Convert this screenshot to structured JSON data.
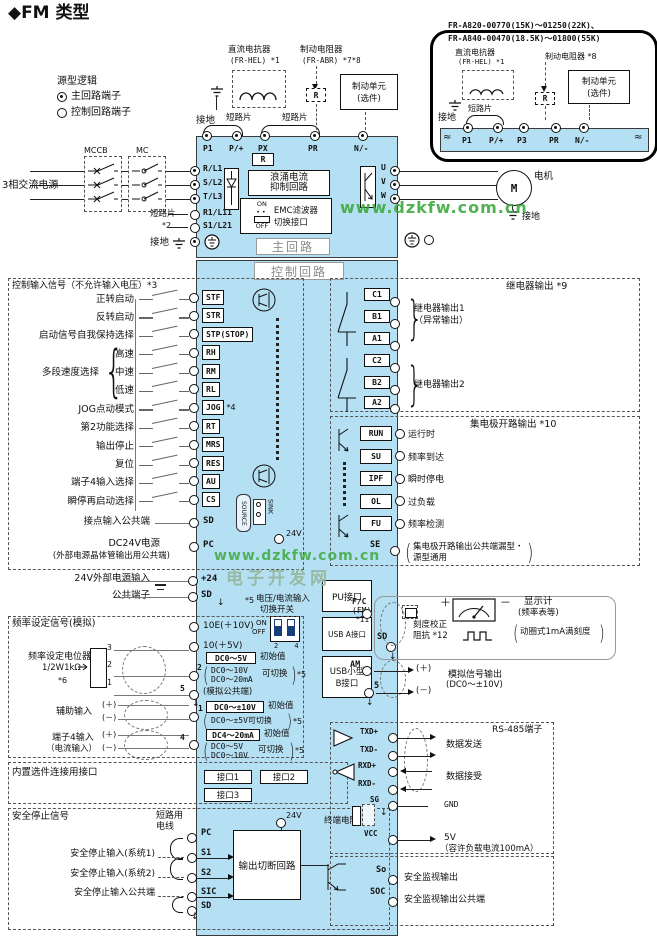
{
  "title": "◆FM 类型",
  "glyphs": {
    "paren_l": "(",
    "paren_r": ")",
    "brace_l": "{",
    "brace_r": "}",
    "arrow_down": "↓",
    "squiggle": "≈"
  },
  "legend": {
    "heading": "源型逻辑",
    "main": "主回路端子",
    "control": "控制回路端子"
  },
  "watermarks": {
    "url1": "www.dzkfw.com.cn",
    "url2": "www.dzkfw.com.cn",
    "site": "电子开发网"
  },
  "inset": {
    "model1": "FR-A820-00770(15K)～01250(22K)、",
    "model2": "FR-A840-00470(18.5K)～01800(55K)",
    "reactor_name": "直流电抗器",
    "reactor_model": "(FR-HEL) *1",
    "ground": "接地",
    "jumper": "短路片",
    "brake_resistor": "制动电阻器 *8",
    "r": "R",
    "brake_unit": "制动单元",
    "brake_unit_opt": "(选件)",
    "terminals": {
      "t1": "P1",
      "t2": "P/+",
      "t3": "P3",
      "t4": "PR",
      "t5": "N/-"
    }
  },
  "top": {
    "reactor_name": "直流电抗器",
    "reactor_model": "(FR-HEL) *1",
    "brake_resistor": "制动电阻器",
    "brake_resistor_model": "(FR-ABR) *7*8",
    "brake_unit": "制动单元",
    "brake_unit_opt": "(选件)",
    "ground": "接地",
    "jumper_left": "短路片",
    "jumper_right": "短路片",
    "r": "R",
    "terminals": {
      "t1": "P1",
      "t2": "P/+",
      "t3": "PX",
      "t4": "PR",
      "t5": "N/-"
    }
  },
  "main": {
    "mccb": "MCCB",
    "mc": "MC",
    "power": "3相交流电源",
    "r_l1": "R/L1",
    "s_l2": "S/L2",
    "t_l3": "T/L3",
    "r1_l11": "R1/L11",
    "s1_l21": "S1/L21",
    "jumper": "短路片",
    "jumper_note": "*2",
    "ground_in": "接地",
    "r": "R",
    "surge1": "浪涌电流",
    "surge2": "抑制回路",
    "emc_on": "ON",
    "emc_off": "OFF",
    "emc1": "EMC滤波器",
    "emc2": "切换接口",
    "main_circuit": "主回路",
    "control_circuit": "控制回路",
    "u": "U",
    "v": "V",
    "w": "W",
    "motor": "M",
    "motor_label": "电机",
    "ground_out": "接地"
  },
  "inputs": {
    "heading": "控制输入信号（不允许输入电压）*3",
    "rows": [
      {
        "label": "正转启动",
        "term": "STF"
      },
      {
        "label": "反转启动",
        "term": "STR"
      },
      {
        "label": "启动信号自我保持选择",
        "term": "STP(STOP)"
      },
      {
        "label": "高速",
        "term": "RH"
      },
      {
        "label": "中速",
        "term": "RM"
      },
      {
        "label": "低速",
        "term": "RL"
      },
      {
        "label": "JOG点动模式",
        "term": "JOG",
        "note": "*4"
      },
      {
        "label": "第2功能选择",
        "term": "RT"
      },
      {
        "label": "输出停止",
        "term": "MRS"
      },
      {
        "label": "复位",
        "term": "RES"
      },
      {
        "label": "端子4输入选择",
        "term": "AU"
      },
      {
        "label": "瞬停再启动选择",
        "term": "CS"
      }
    ],
    "group_label": "多段速度选择",
    "common_label": "接点输入公共端",
    "common_term": "SD",
    "pc_label1": "DC24V电源",
    "pc_label2": "(外部电源晶体管输出用公共端)",
    "pc_term": "PC",
    "sink": "SINK",
    "source": "SOURCE",
    "v24": "24V"
  },
  "ext": {
    "label24": "24V外部电源输入",
    "term24": "+24",
    "label_sd": "公共端子",
    "term_sd": "SD"
  },
  "freq": {
    "heading": "频率设定信号(模拟)",
    "sw_note": "*5",
    "sw1": "电压/电流输入",
    "sw2": "切换开关",
    "sw_on": "ON",
    "sw_off": "OFF",
    "sw_pins": "2 4",
    "t10e": "10E(＋10V)",
    "t10": "10(＋5V)",
    "pot1": "频率设定电位器",
    "pot2": "1/2W1kΩ",
    "pot_note": "*6",
    "pin3": "3",
    "pin2": "2",
    "pin1": "1",
    "t2": "2",
    "t2_range": "DC0～5V",
    "t2_init": "初始值",
    "t2_alt1": "DC0～10V",
    "t2_alt2": "DC0～20mA",
    "t2_sw": "可切换",
    "t2_note": "*5",
    "t5": "5",
    "t5_label": "(模拟公共端)",
    "aux": "辅助输入",
    "plus": "(＋)",
    "minus": "(－)",
    "t1": "1",
    "t1_range": "DC0～±10V",
    "t1_init": "初始值",
    "t1_alt": "DC0～±5V可切换",
    "t1_note": "*5",
    "t4lbl1": "端子4输入",
    "t4lbl2": "（电流输入）",
    "t4": "4",
    "t4_range": "DC4～20mA",
    "t4_init": "初始值",
    "t4_alt1": "DC0～5V",
    "t4_alt2": "DC0～10V",
    "t4_sw": "可切换",
    "t4_note": "*5"
  },
  "option": {
    "heading": "内置选件连接用接口",
    "port1": "接口1",
    "port2": "接口2",
    "port3": "接口3"
  },
  "safety": {
    "heading": "安全停止信号",
    "wire1": "短路用",
    "wire2": "电线",
    "v24": "24V",
    "pc": "PC",
    "s1": "S1",
    "s2": "S2",
    "sic": "SIC",
    "sd": "SD",
    "in1": "安全停止输入(系统1)",
    "in2": "安全停止输入(系统2)",
    "in3": "安全停止输入公共端",
    "block": "输出切断回路",
    "so": "So",
    "so_label": "安全监视输出",
    "soc": "SOC",
    "soc_label": "安全监视输出公共端"
  },
  "relay": {
    "heading": "继电器输出 *9",
    "c1": "C1",
    "b1": "B1",
    "a1": "A1",
    "c2": "C2",
    "b2": "B2",
    "a2": "A2",
    "out1a": "继电器输出1",
    "out1b": "（异常输出）",
    "out2": "继电器输出2"
  },
  "oc": {
    "heading": "集电极开路输出 *10",
    "rows": [
      {
        "term": "RUN",
        "label": "运行时"
      },
      {
        "term": "SU",
        "label": "频率到达"
      },
      {
        "term": "IPF",
        "label": "瞬时停电"
      },
      {
        "term": "OL",
        "label": "过负载"
      },
      {
        "term": "FU",
        "label": "频率检测"
      }
    ],
    "se": "SE",
    "se1": "集电极开路输出公共端漏型・",
    "se2": "源型通用"
  },
  "ports": {
    "pu": "PU接口",
    "usba": "USB A接口",
    "usbb1": "USB小型",
    "usbb2": "B接口"
  },
  "fm": {
    "t1a": "F/C",
    "t1b": "(FM)",
    "note": "*11",
    "t2": "SD",
    "cal1": "刻度校正",
    "cal2": "阻抗 *12",
    "plus": "＋",
    "minus": "－",
    "disp1": "显示计",
    "disp2": "(频率表等)",
    "disp3": "动圈式1mA满刻度"
  },
  "am": {
    "t1": "AM",
    "t2": "5",
    "plus": "(＋)",
    "minus": "(－)",
    "label1": "模拟信号输出",
    "label2": "(DC0～±10V)"
  },
  "rs485": {
    "heading": "RS-485端子",
    "txdp": "TXD+",
    "txdm": "TXD-",
    "rxdp": "RXD+",
    "rxdm": "RXD-",
    "tx_label": "数据发送",
    "rx_label": "数据接受",
    "sg": "SG",
    "gnd": "GND",
    "res": "终端电阻",
    "vcc": "VCC",
    "v5": "5V",
    "v5_note": "（容许负载电流100mA）"
  }
}
